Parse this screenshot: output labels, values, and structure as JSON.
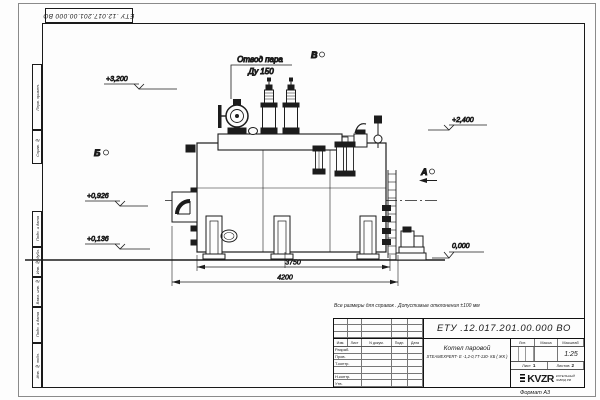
{
  "sheet": {
    "stamp_top": "ЕТУ .12.017.201.00.000  ВО",
    "format_label": "Формат А3",
    "margin_labels": [
      "Перв. примен.",
      "Справ. №",
      "Подп. и дата",
      "Инв. № дубл.",
      "Взам. инв. №",
      "Подп. и дата",
      "Инв. № подл."
    ]
  },
  "note": "Все размеры для справок . Допустимые отклонения  ±100  мм",
  "drawing": {
    "callout": {
      "line1": "Отвод пара",
      "line2": "Ду 150"
    },
    "views": {
      "a": "А",
      "b": "Б",
      "v": "В"
    },
    "elevations": [
      "+3,200",
      "+2,400",
      "+0,926",
      "+0,136",
      "0,000"
    ],
    "dimensions": {
      "inner": "3750",
      "outer": "4200"
    }
  },
  "title_block": {
    "doc_number": "ЕТУ .12.017.201.00.000  ВО",
    "product_name": "Котел паровой",
    "product_model": "STEAMEXPERT- E -1,2-0,7Т-130- КБ ( ЖК )",
    "headers": {
      "lit": "Лит.",
      "mass": "Масса",
      "scale": "Масштаб"
    },
    "scale_value": "1:25",
    "sheet_label": "Лист",
    "sheet_value": "1",
    "sheets_label": "Листов",
    "sheets_value": "2",
    "columns": {
      "izm": "Изм.",
      "list": "Лист",
      "doc": "N докум.",
      "podp": "Подп.",
      "data": "Дата"
    },
    "roles": [
      "Разраб.",
      "Пров.",
      "Т.контр.",
      "",
      "Н.контр.",
      "Утв."
    ],
    "logo_text": "KVZR",
    "org_line1": "КОТЕЛЬНЫЙ",
    "org_line2": "ЗАВОД РФ"
  }
}
